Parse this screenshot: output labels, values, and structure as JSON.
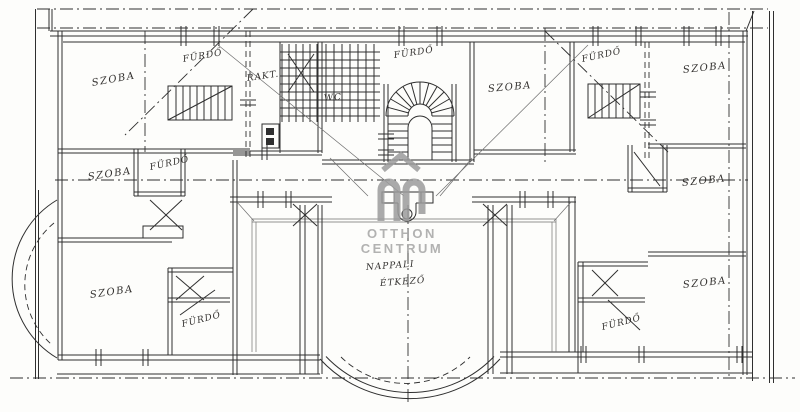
{
  "watermark": {
    "logo_initials": "OC",
    "line1": "OTTHON",
    "line2": "CENTRUM",
    "logo_color": "#9b9b9b",
    "text_color": "#aaaaaa",
    "roof_icon": "roof-chevron-icon"
  },
  "plan": {
    "background": "#fdfdfb",
    "ink_color": "#2f2f2f",
    "labels": [
      {
        "id": "szoba-top-left",
        "text": "SZOBA"
      },
      {
        "id": "furdo-top-left",
        "text": "FÜRDŐ"
      },
      {
        "id": "rakt-top",
        "text": "RAKT."
      },
      {
        "id": "wc",
        "text": "WC"
      },
      {
        "id": "furdo-top-center",
        "text": "FÜRDŐ"
      },
      {
        "id": "szoba-top-mid-right",
        "text": "SZOBA"
      },
      {
        "id": "furdo-top-right",
        "text": "FÜRDŐ"
      },
      {
        "id": "szoba-top-right",
        "text": "SZOBA"
      },
      {
        "id": "szoba-mid-left",
        "text": "SZOBA"
      },
      {
        "id": "furdo-mid-left",
        "text": "FÜRDŐ"
      },
      {
        "id": "szoba-bottom-left",
        "text": "SZOBA"
      },
      {
        "id": "furdo-bottom-left",
        "text": "FÜRDŐ"
      },
      {
        "id": "szoba-mid-right",
        "text": "SZOBA"
      },
      {
        "id": "szoba-bottom-right",
        "text": "SZOBA"
      },
      {
        "id": "furdo-bottom-right",
        "text": "FÜRDŐ"
      },
      {
        "id": "nappali",
        "text": "NAPPALI"
      },
      {
        "id": "etkezo",
        "text": "ÉTKEZŐ"
      }
    ]
  }
}
